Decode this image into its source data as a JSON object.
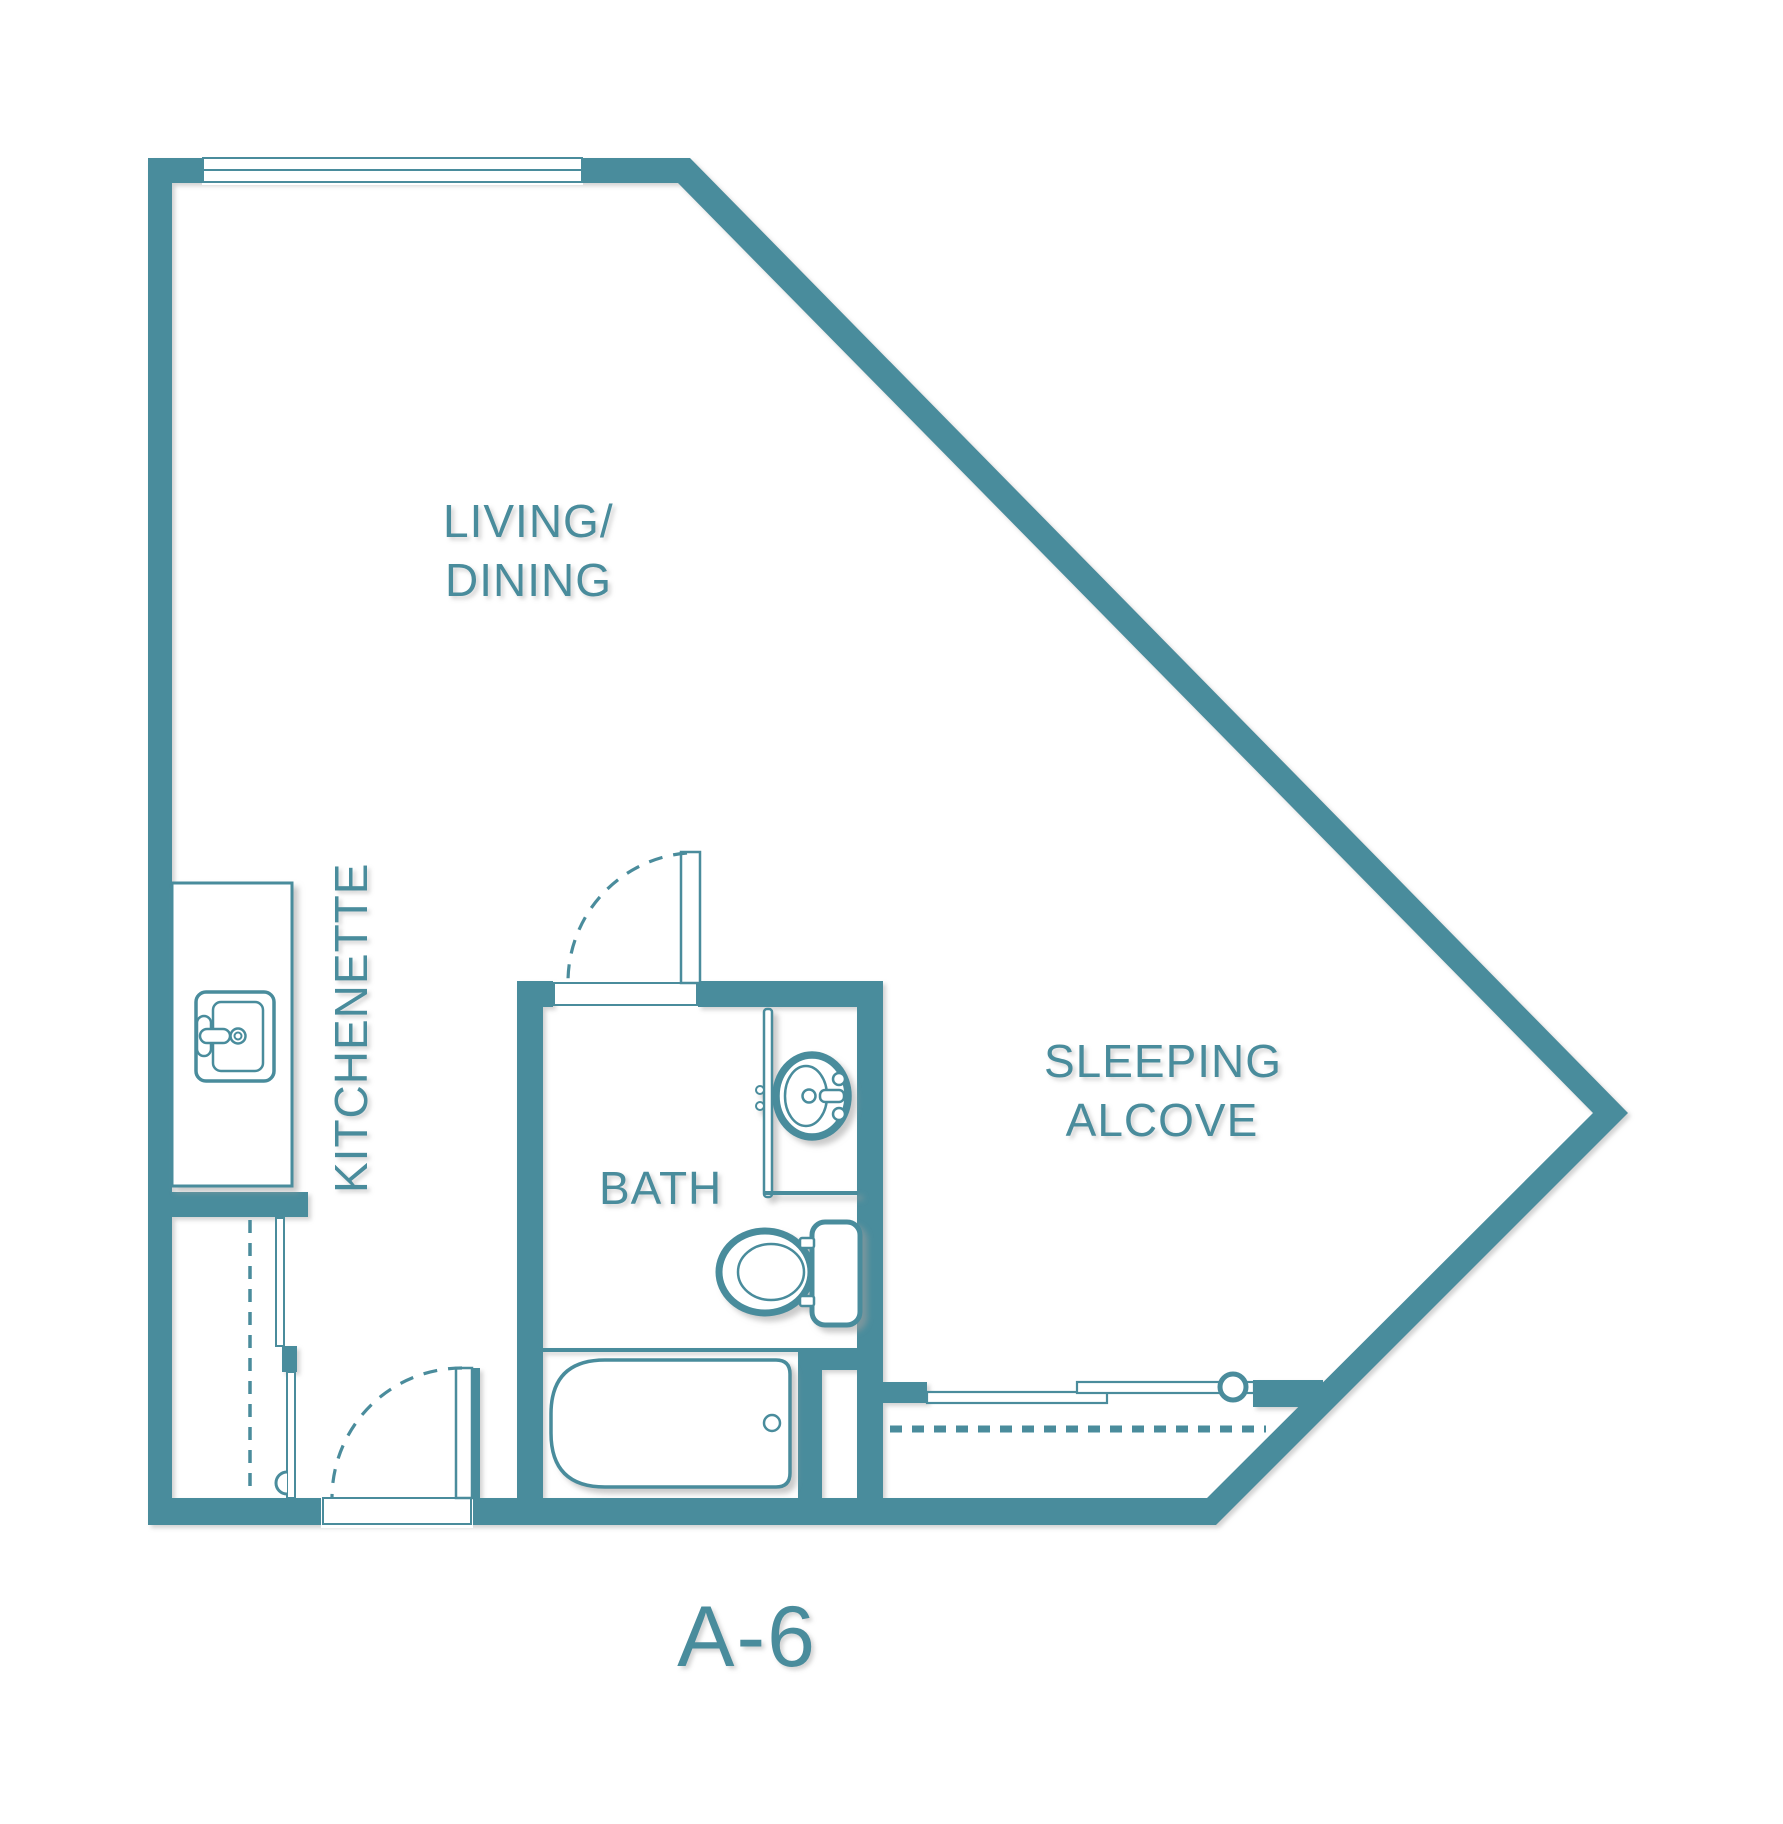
{
  "plan": {
    "name": "A-6"
  },
  "labels": {
    "living_dining": {
      "line1": "LIVING/",
      "line2": "DINING"
    },
    "kitchenette": "KITCHENETTE",
    "bath": "BATH",
    "sleeping_alcove": {
      "line1": "SLEEPING",
      "line2": "ALCOVE"
    }
  },
  "fixtures": [
    "window",
    "kitchen-counter",
    "kitchen-sink",
    "closet-rod-dashed",
    "closet-sliding-doors",
    "entry-door-swing",
    "bath-door-swing",
    "vanity-counter",
    "bathroom-sink",
    "toilet",
    "bathtub",
    "sleeping-closet-sliding-doors",
    "sleeping-closet-rod-dashed"
  ],
  "colors": {
    "wall": "#4A8C9C",
    "background": "#FFFFFF",
    "shadow": "#9E9E9E"
  }
}
